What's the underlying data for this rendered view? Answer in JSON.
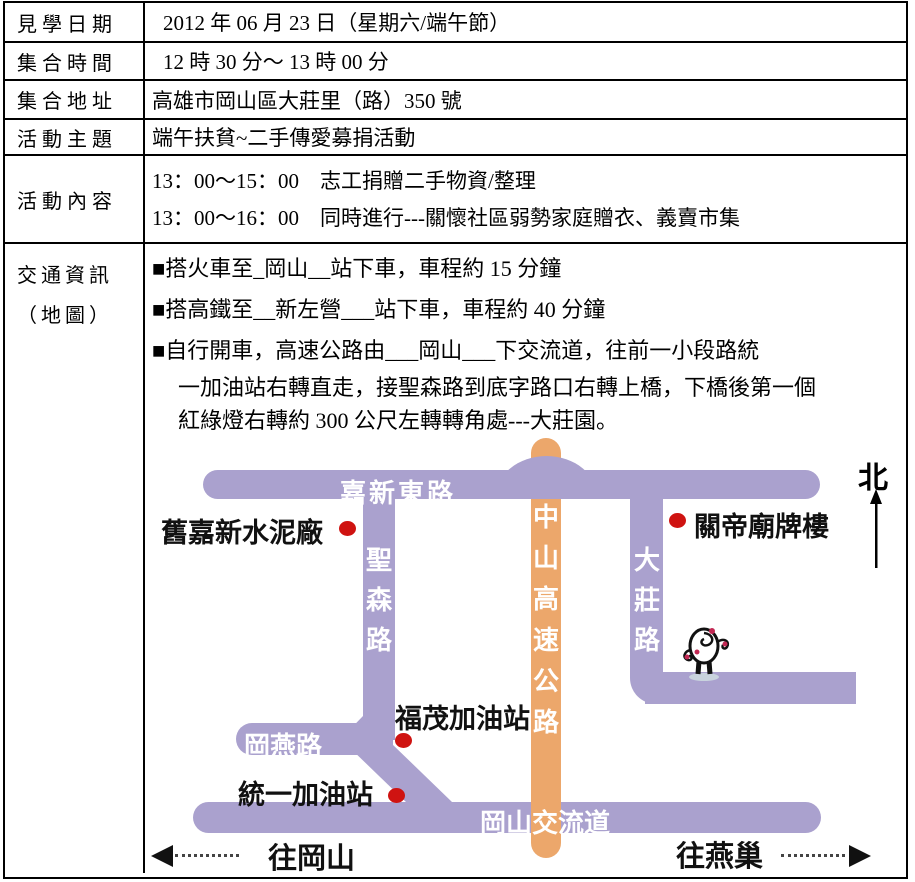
{
  "table": {
    "row1": {
      "label": "見學日期",
      "value": "2012 年 06 月 23 日（星期六/端午節）"
    },
    "row2": {
      "label": "集合時間",
      "value": "12 時 30 分～ 13 時 00 分"
    },
    "row3": {
      "label": "集合地址",
      "value": "高雄市岡山區大莊里（路）350 號"
    },
    "row4": {
      "label": "活動主題",
      "value": "端午扶貧~二手傳愛募捐活動"
    },
    "row5": {
      "label": "活動內容",
      "line1": "13：00～15：00　志工捐贈二手物資/整理",
      "line2": "13：00～16：00　同時進行---關懷社區弱勢家庭贈衣、義賣市集"
    },
    "row6": {
      "label_line1": "交通資訊",
      "label_line2": "（地圖）",
      "bullet1": "■搭火車至_岡山__站下車，車程約 15 分鐘",
      "bullet2": "■搭高鐵至__新左營___站下車，車程約 40 分鐘",
      "bullet3": "■自行開車，高速公路由___岡山___下交流道，往前一小段路統",
      "cont1": "一加油站右轉直走，接聖森路到底字路口右轉上橋，下橋後第一個",
      "cont2": "紅綠燈右轉約 300 公尺左轉轉角處---大莊園。"
    }
  },
  "map": {
    "colors": {
      "road_purple": "#aaa1ce",
      "highway_orange": "#eca76b",
      "marker_red": "#cf1311"
    },
    "road_labels": {
      "jiaxin_east": "嘉新東路",
      "shengsen": "聖森路",
      "dazhuang": "大莊路",
      "zhongshan_highway": "中山高速公路",
      "gangyan": "岡燕路",
      "gangshan_interchange": "岡山交流道"
    },
    "poi": {
      "old_cement_factory": "舊嘉新水泥廠",
      "guandi_temple_gate": "關帝廟牌樓",
      "fumao_gas_station": "福茂加油站",
      "uni_gas_station": "統一加油站"
    },
    "compass_north": "北",
    "directions": {
      "to_gangshan": "往岡山",
      "to_yanchao": "往燕巢"
    }
  }
}
